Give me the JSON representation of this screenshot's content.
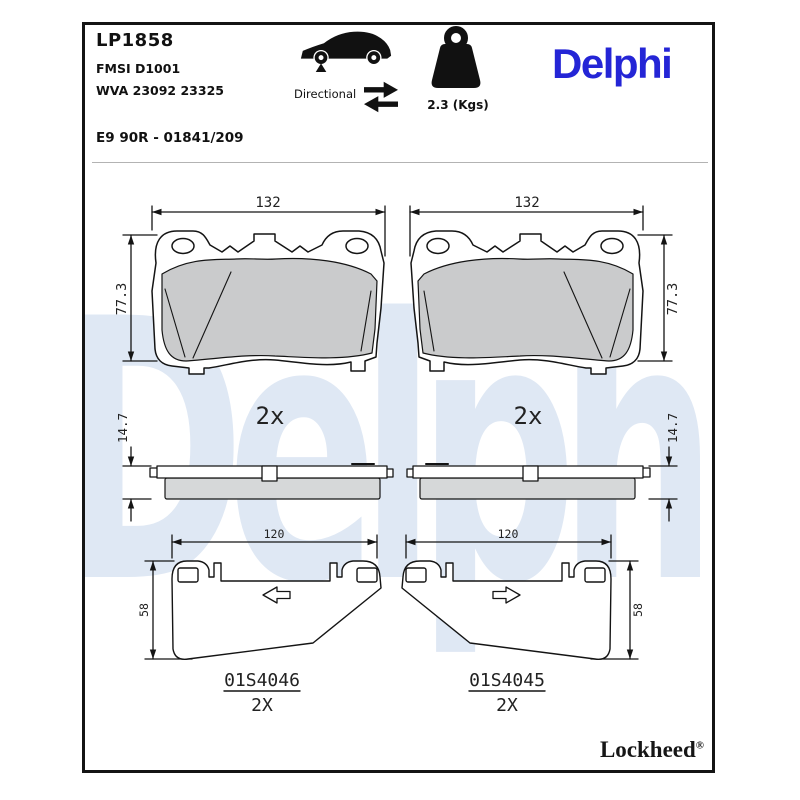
{
  "header": {
    "part_number": "LP1858",
    "fmsi": "FMSI D1001",
    "wva": "WVA 23092 23325",
    "approval": "E9 90R - 01841/209",
    "directional_label": "Directional",
    "weight_value": "2.3 (Kgs)",
    "brand_logo": "Delphi",
    "icons": {
      "car": "car-silhouette-icon",
      "front_axle_marker": "front-axle-arrow-icon",
      "directional_arrows": "two-way-arrows-icon",
      "weight": "weight-kettlebell-icon"
    }
  },
  "watermark_text": "Delphi",
  "drawings": {
    "pad_front": {
      "width_mm": "132",
      "height_mm": "77.3",
      "quantity": "2x"
    },
    "pad_side": {
      "thickness_mm": "14.7"
    },
    "shim_left": {
      "width_mm": "120",
      "height_mm": "58",
      "part_code": "01S4046",
      "quantity": "2X"
    },
    "shim_right": {
      "width_mm": "120",
      "height_mm": "58",
      "part_code": "01S4045",
      "quantity": "2X"
    }
  },
  "footer": {
    "brand": "Lockheed",
    "registered_mark": "®"
  },
  "colors": {
    "brand_blue": "#2425d6",
    "watermark_blue": "#dfe8f4",
    "friction_gray": "#cacbcc",
    "line_black": "#141414"
  }
}
